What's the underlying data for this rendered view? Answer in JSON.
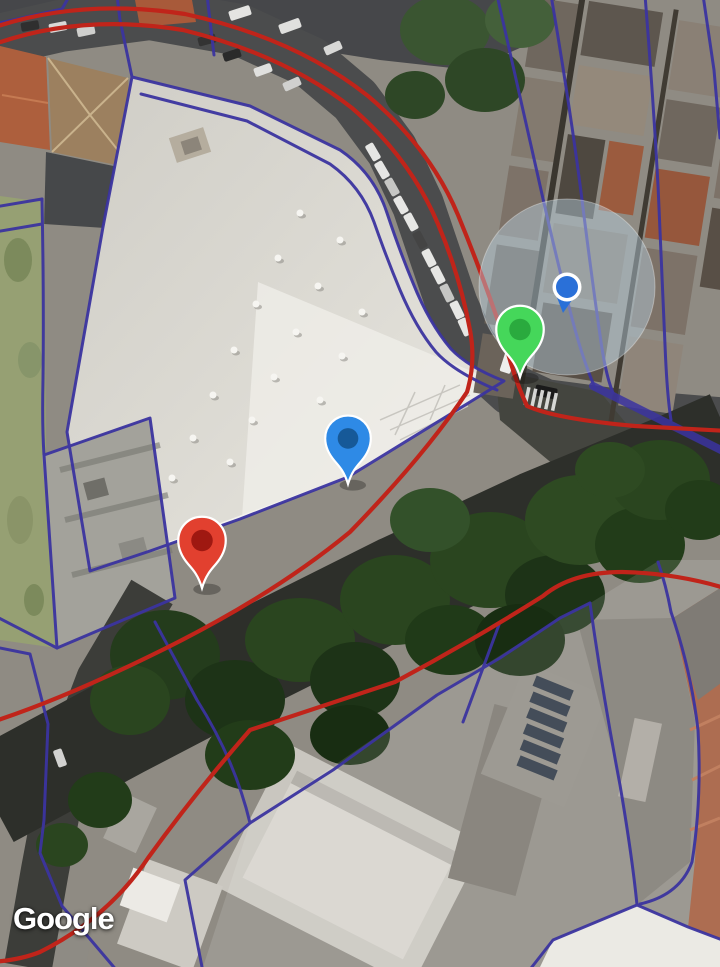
{
  "map": {
    "view_type": "satellite",
    "attribution": "Google",
    "overlay": {
      "route_color": "#c0241a",
      "parcel_line_color": "#3b34a0",
      "accuracy_fill": "rgba(183,208,224,0.45)",
      "markers": [
        {
          "id": "red",
          "color": "#e2402f",
          "inner_color": "#98140e",
          "x": 202,
          "y": 588,
          "scale": 1.25
        },
        {
          "id": "blue",
          "color": "#2e8ae6",
          "inner_color": "#14538f",
          "x": 348,
          "y": 484,
          "scale": 1.2
        },
        {
          "id": "green",
          "color": "#45d75a",
          "inner_color": "#27a53b",
          "x": 520,
          "y": 377,
          "scale": 1.25
        }
      ],
      "location_indicator": {
        "x": 567,
        "y": 287,
        "radius": 88,
        "dot_color": "#2a70d8"
      }
    }
  }
}
